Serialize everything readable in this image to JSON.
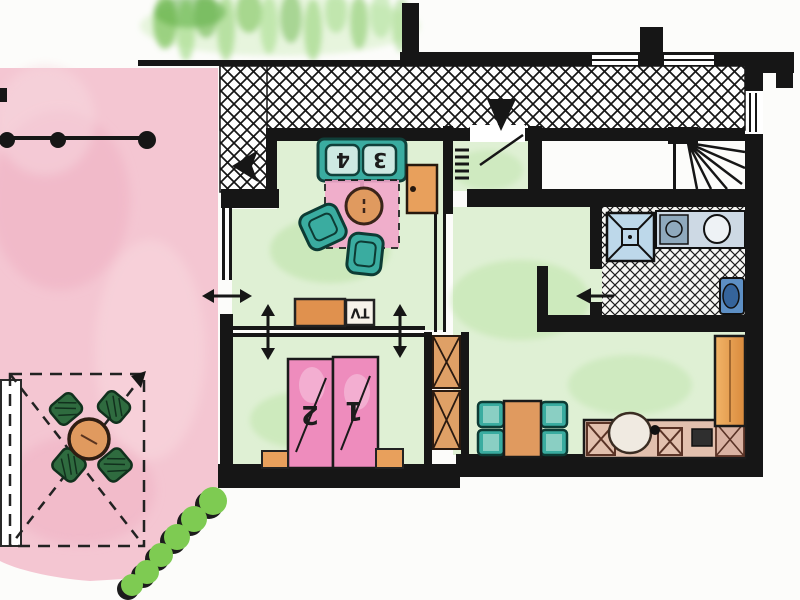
{
  "floor_plan": {
    "labels": {
      "sofa_seat_left": "4",
      "sofa_seat_right": "3",
      "bed_left": "2",
      "bed_right": "1",
      "tv_unit": "TV"
    },
    "palette": {
      "paper": "#fcfcfa",
      "wall": "#161616",
      "terrace-pink": "#f4c6d2",
      "terrace-pink-deep": "#eeaabf",
      "rug-pink": "#f2a7cb",
      "bed-pink": "#ee8cbd",
      "room-green": "#dff0d4",
      "blotch-green": "#b7e2a2",
      "garden-green": "#7cc35a",
      "bush-green": "#7ecb52",
      "teal": "#3aaca0",
      "teal-dark": "#0d3b34",
      "seat-light": "#cde9e2",
      "orange": "#e8a05c",
      "orange-deep": "#e09a5f",
      "terrace-chair": "#2f6b3f",
      "shower-blue": "#bdd8ea",
      "fixture-blue": "#5d8fc4",
      "counter-tan": "#e2c0ae"
    }
  }
}
